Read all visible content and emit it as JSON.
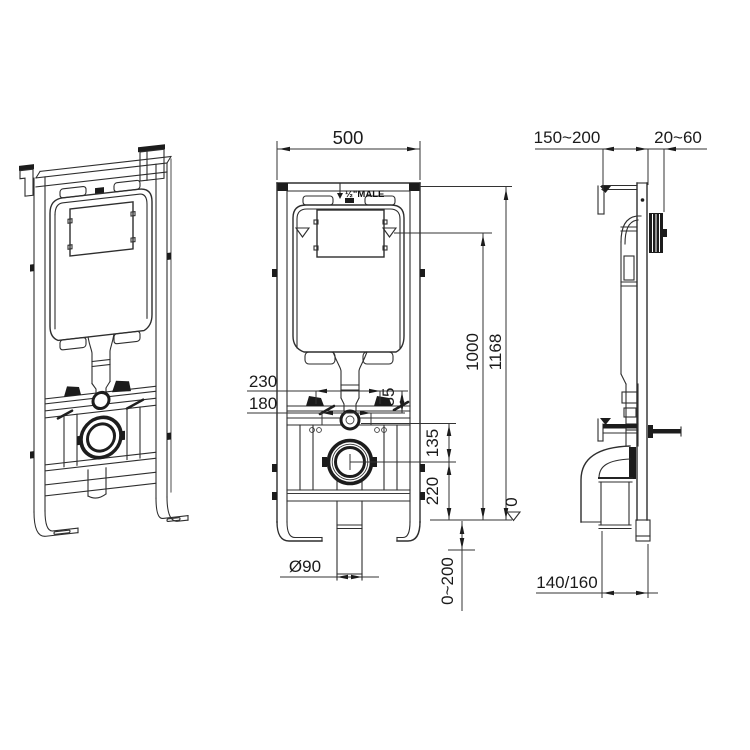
{
  "drawing": {
    "background_color": "#ffffff",
    "line_color": "#2e2e2e",
    "text_color": "#1b1b1b",
    "front_view": {
      "dim_width": "500",
      "dim_height_to_water": "1000",
      "dim_total_height": "1168",
      "dim_upper_holes": "230",
      "dim_lower_holes": "180",
      "dim_offset": "35",
      "dim_rod_to_outlet": "135",
      "dim_outlet_height": "220",
      "dim_drain_diameter": "Ø90",
      "dim_floor_adjust": "0~200",
      "datum_zero": "0",
      "inlet_thread_label": "½\"MALE"
    },
    "side_view": {
      "dim_frame_depth": "150~200",
      "dim_plate_depth": "20~60",
      "dim_outlet_depth": "140/160"
    }
  }
}
